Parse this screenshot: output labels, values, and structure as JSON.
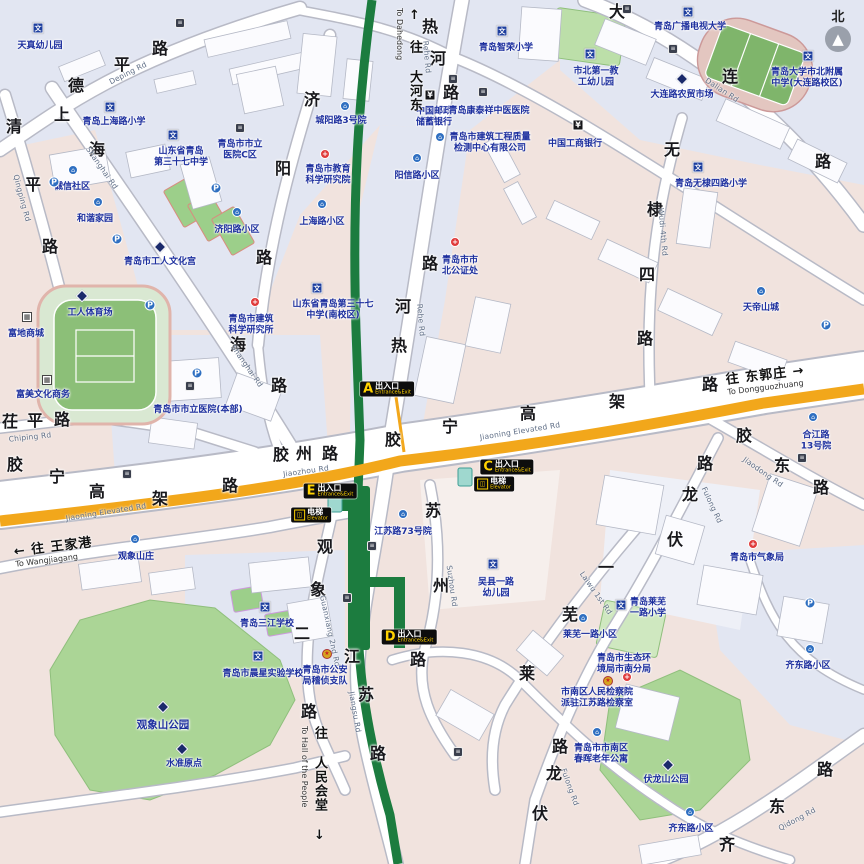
{
  "map": {
    "colors": {
      "metro_green": "#1c7c3f",
      "elevated_yellow": "#f2a71b",
      "park_green": "#abd596",
      "exit_badge_bg": "#0d0d0d",
      "exit_letter_yellow": "#ffd200",
      "label_blue": "#1d2f9e"
    },
    "compass": {
      "label": "北",
      "arrow": "▲"
    },
    "exits": [
      {
        "letter": "A",
        "cn": "出入口",
        "en": "Entrance&Exit",
        "x": 387,
        "y": 389
      },
      {
        "letter": "C",
        "cn": "出入口",
        "en": "Entrance&Exit",
        "x": 507,
        "y": 467
      },
      {
        "letter": "E",
        "cn": "出入口",
        "en": "Entrance&Exit",
        "x": 330,
        "y": 491
      },
      {
        "letter": "D",
        "cn": "出入口",
        "en": "Entrance&Exit",
        "x": 409,
        "y": 637
      }
    ],
    "elevators": [
      {
        "cn": "电梯",
        "en": "Elevator",
        "x": 311,
        "y": 515
      },
      {
        "cn": "电梯",
        "en": "Elevator",
        "x": 494,
        "y": 484
      }
    ],
    "direction_signs": [
      {
        "id": "to-dahedong",
        "arrow": "↑",
        "cn": "往 大河东",
        "en": "To Dahedong",
        "x": 395,
        "y": 8,
        "orient": "v"
      },
      {
        "id": "to-wangjiagang",
        "arrow": "←",
        "cn": "往 王家港",
        "en": "To Wangjiagang",
        "x": 14,
        "y": 536,
        "orient": "h"
      },
      {
        "id": "to-dongguozhuang",
        "arrow": "→",
        "cn": "往 东郭庄",
        "en": "To Dongguozhuang",
        "x": 726,
        "y": 364,
        "orient": "hr"
      },
      {
        "id": "to-hall-of-the-people",
        "arrow": "↓",
        "cn": "往 人民会堂",
        "en": "To Hall of the People",
        "x": 300,
        "y": 726,
        "orient": "vd"
      }
    ],
    "road_chars": [
      {
        "t": "德",
        "x": 76,
        "y": 84
      },
      {
        "t": "平",
        "x": 122,
        "y": 63
      },
      {
        "t": "路",
        "x": 160,
        "y": 47
      },
      {
        "t": "清",
        "x": 14,
        "y": 125
      },
      {
        "t": "平",
        "x": 33,
        "y": 183
      },
      {
        "t": "路",
        "x": 50,
        "y": 245
      },
      {
        "t": "上",
        "x": 62,
        "y": 113
      },
      {
        "t": "海",
        "x": 97,
        "y": 148
      },
      {
        "t": "海",
        "x": 238,
        "y": 343
      },
      {
        "t": "路",
        "x": 279,
        "y": 384
      },
      {
        "t": "济",
        "x": 312,
        "y": 98
      },
      {
        "t": "阳",
        "x": 283,
        "y": 167
      },
      {
        "t": "路",
        "x": 264,
        "y": 256
      },
      {
        "t": "热",
        "x": 430,
        "y": 25
      },
      {
        "t": "河",
        "x": 438,
        "y": 57
      },
      {
        "t": "路",
        "x": 451,
        "y": 91
      },
      {
        "t": "路",
        "x": 430,
        "y": 262
      },
      {
        "t": "河",
        "x": 403,
        "y": 305
      },
      {
        "t": "热",
        "x": 399,
        "y": 344
      },
      {
        "t": "大",
        "x": 617,
        "y": 10
      },
      {
        "t": "连",
        "x": 730,
        "y": 75
      },
      {
        "t": "路",
        "x": 823,
        "y": 160
      },
      {
        "t": "无",
        "x": 672,
        "y": 148
      },
      {
        "t": "棣",
        "x": 655,
        "y": 208
      },
      {
        "t": "四",
        "x": 647,
        "y": 273
      },
      {
        "t": "路",
        "x": 645,
        "y": 337
      },
      {
        "t": "胶",
        "x": 15,
        "y": 463
      },
      {
        "t": "宁",
        "x": 57,
        "y": 475
      },
      {
        "t": "高",
        "x": 97,
        "y": 490
      },
      {
        "t": "架",
        "x": 160,
        "y": 497
      },
      {
        "t": "路",
        "x": 230,
        "y": 484
      },
      {
        "t": "胶",
        "x": 393,
        "y": 438
      },
      {
        "t": "宁",
        "x": 450,
        "y": 425
      },
      {
        "t": "高",
        "x": 528,
        "y": 412
      },
      {
        "t": "架",
        "x": 617,
        "y": 400
      },
      {
        "t": "路",
        "x": 710,
        "y": 383
      },
      {
        "t": "胶",
        "x": 281,
        "y": 453
      },
      {
        "t": "州",
        "x": 304,
        "y": 452
      },
      {
        "t": "路",
        "x": 330,
        "y": 452
      },
      {
        "t": "茌",
        "x": 10,
        "y": 420
      },
      {
        "t": "平",
        "x": 35,
        "y": 419
      },
      {
        "t": "路",
        "x": 62,
        "y": 418
      },
      {
        "t": "苏",
        "x": 433,
        "y": 509
      },
      {
        "t": "州",
        "x": 441,
        "y": 584
      },
      {
        "t": "路",
        "x": 418,
        "y": 658
      },
      {
        "t": "江",
        "x": 352,
        "y": 655
      },
      {
        "t": "苏",
        "x": 366,
        "y": 693
      },
      {
        "t": "路",
        "x": 378,
        "y": 752
      },
      {
        "t": "观",
        "x": 325,
        "y": 545
      },
      {
        "t": "象",
        "x": 318,
        "y": 588
      },
      {
        "t": "二",
        "x": 302,
        "y": 632
      },
      {
        "t": "路",
        "x": 309,
        "y": 710
      },
      {
        "t": "一",
        "x": 606,
        "y": 566
      },
      {
        "t": "芜",
        "x": 570,
        "y": 613
      },
      {
        "t": "莱",
        "x": 527,
        "y": 672
      },
      {
        "t": "伏",
        "x": 675,
        "y": 538
      },
      {
        "t": "龙",
        "x": 690,
        "y": 493
      },
      {
        "t": "路",
        "x": 705,
        "y": 462
      },
      {
        "t": "伏",
        "x": 540,
        "y": 812
      },
      {
        "t": "龙",
        "x": 554,
        "y": 772
      },
      {
        "t": "路",
        "x": 560,
        "y": 745
      },
      {
        "t": "胶",
        "x": 744,
        "y": 434
      },
      {
        "t": "东",
        "x": 782,
        "y": 464
      },
      {
        "t": "路",
        "x": 821,
        "y": 486
      },
      {
        "t": "齐",
        "x": 727,
        "y": 843
      },
      {
        "t": "东",
        "x": 777,
        "y": 805
      },
      {
        "t": "路",
        "x": 825,
        "y": 768
      }
    ],
    "road_names_en": [
      {
        "t": "Deping Rd",
        "x": 128,
        "y": 73,
        "r": -27
      },
      {
        "t": "Qingping Rd",
        "x": 22,
        "y": 198,
        "r": 75
      },
      {
        "t": "Shanghai Rd",
        "x": 102,
        "y": 168,
        "r": 55
      },
      {
        "t": "Shanghai Rd",
        "x": 247,
        "y": 366,
        "r": 55
      },
      {
        "t": "Rehe Rd",
        "x": 427,
        "y": 57,
        "r": 85
      },
      {
        "t": "Rehe Rd",
        "x": 421,
        "y": 320,
        "r": 85
      },
      {
        "t": "Jiaozhou Rd",
        "x": 306,
        "y": 471,
        "r": -8
      },
      {
        "t": "Jiaoning Elevated Rd",
        "x": 106,
        "y": 512,
        "r": -9
      },
      {
        "t": "Jiaoning Elevated Rd",
        "x": 520,
        "y": 431,
        "r": -9
      },
      {
        "t": "Chiping Rd",
        "x": 30,
        "y": 437,
        "r": -6
      },
      {
        "t": "Dalian Rd",
        "x": 722,
        "y": 90,
        "r": 33
      },
      {
        "t": "Wudi 4th Rd",
        "x": 663,
        "y": 232,
        "r": 85
      },
      {
        "t": "Suzhou Rd",
        "x": 452,
        "y": 586,
        "r": 82
      },
      {
        "t": "Jiangsu Rd",
        "x": 355,
        "y": 712,
        "r": 80
      },
      {
        "t": "Guanxiang 2nd Rd",
        "x": 330,
        "y": 631,
        "r": 78
      },
      {
        "t": "Laiwu 1st Rd",
        "x": 596,
        "y": 593,
        "r": 55
      },
      {
        "t": "Fulong Rd",
        "x": 712,
        "y": 505,
        "r": 65
      },
      {
        "t": "Fulong Rd",
        "x": 570,
        "y": 787,
        "r": 70
      },
      {
        "t": "Jiaodong Rd",
        "x": 763,
        "y": 472,
        "r": 35
      },
      {
        "t": "Qidong Rd",
        "x": 797,
        "y": 819,
        "r": -28
      }
    ],
    "pois": [
      {
        "icon": "wen",
        "x": 38,
        "y": 28,
        "lines": [
          "天真幼儿园"
        ],
        "tx": 40,
        "ty": 46
      },
      {
        "icon": "wen",
        "x": 110,
        "y": 107,
        "lines": [
          "青岛上海路小学"
        ],
        "tx": 114,
        "ty": 122
      },
      {
        "icon": "wen",
        "x": 173,
        "y": 135,
        "lines": [
          "山东省青岛",
          "第三十七中学"
        ],
        "tx": 181,
        "ty": 152
      },
      {
        "icon": "circle",
        "x": 73,
        "y": 170,
        "lines": [
          "诚信社区"
        ],
        "tx": 72,
        "ty": 187
      },
      {
        "icon": "circle",
        "x": 98,
        "y": 202,
        "lines": [
          "和谐家园"
        ],
        "tx": 95,
        "ty": 219
      },
      {
        "icon": "p",
        "x": 54,
        "y": 182,
        "lines": []
      },
      {
        "icon": "p",
        "x": 117,
        "y": 239,
        "lines": []
      },
      {
        "icon": "p",
        "x": 216,
        "y": 188,
        "lines": []
      },
      {
        "icon": "diamond",
        "x": 160,
        "y": 247,
        "lines": [
          "青岛市工人文化宫"
        ],
        "tx": 160,
        "ty": 262
      },
      {
        "icon": "circle",
        "x": 237,
        "y": 212,
        "lines": [
          "济阳路小区"
        ],
        "tx": 237,
        "ty": 230
      },
      {
        "icon": "dark",
        "x": 240,
        "y": 128,
        "lines": [
          "青岛市市立",
          "医院C区"
        ],
        "tx": 240,
        "ty": 145
      },
      {
        "icon": "dark",
        "x": 180,
        "y": 23,
        "lines": []
      },
      {
        "icon": "wen",
        "x": 317,
        "y": 288,
        "lines": [
          "山东省青岛第三十七",
          "中学(南校区)"
        ],
        "tx": 333,
        "ty": 305
      },
      {
        "icon": "red",
        "x": 325,
        "y": 154,
        "lines": [
          "青岛市教育",
          "科学研究院"
        ],
        "tx": 328,
        "ty": 170
      },
      {
        "icon": "circle",
        "x": 322,
        "y": 204,
        "lines": [
          "上海路小区"
        ],
        "tx": 322,
        "ty": 222
      },
      {
        "icon": "circle",
        "x": 345,
        "y": 106,
        "lines": [
          "城阳路3号院"
        ],
        "tx": 341,
        "ty": 121
      },
      {
        "icon": "yen",
        "x": 430,
        "y": 95,
        "lines": [
          "中国邮政",
          "储蓄银行"
        ],
        "tx": 434,
        "ty": 112
      },
      {
        "icon": "dark",
        "x": 483,
        "y": 92,
        "lines": [
          "青岛康泰祥中医医院"
        ],
        "tx": 489,
        "ty": 111
      },
      {
        "icon": "circle",
        "x": 440,
        "y": 137,
        "lines": [
          "青岛市建筑工程质量",
          "检测中心有限公司"
        ],
        "tx": 490,
        "ty": 138
      },
      {
        "icon": "wen",
        "x": 502,
        "y": 31,
        "lines": [
          "青岛智荣小学"
        ],
        "tx": 506,
        "ty": 48
      },
      {
        "icon": "red",
        "x": 455,
        "y": 242,
        "lines": [
          "青岛市市",
          "北公证处"
        ],
        "tx": 460,
        "ty": 261
      },
      {
        "icon": "wen",
        "x": 590,
        "y": 54,
        "lines": [
          "市北第一教",
          "工幼儿园"
        ],
        "tx": 596,
        "ty": 72
      },
      {
        "icon": "yen",
        "x": 578,
        "y": 125,
        "lines": [
          "中国工商银行"
        ],
        "tx": 575,
        "ty": 144
      },
      {
        "icon": "wen",
        "x": 688,
        "y": 12,
        "lines": [
          "青岛广播电视大学"
        ],
        "tx": 690,
        "ty": 27
      },
      {
        "icon": "wen",
        "x": 808,
        "y": 56,
        "lines": [
          "青岛大学市北附属",
          "中学(大连路校区)"
        ],
        "tx": 807,
        "ty": 73
      },
      {
        "icon": "diamond",
        "x": 682,
        "y": 79,
        "lines": [
          "大连路农贸市场"
        ],
        "tx": 682,
        "ty": 95
      },
      {
        "icon": "dark",
        "x": 673,
        "y": 49,
        "lines": []
      },
      {
        "icon": "dark",
        "x": 627,
        "y": 9,
        "lines": []
      },
      {
        "icon": "wen",
        "x": 698,
        "y": 167,
        "lines": [
          "青岛无棣四路小学"
        ],
        "tx": 711,
        "ty": 184
      },
      {
        "icon": "dark",
        "x": 190,
        "y": 386,
        "lines": [
          "青岛市市立医院(本部)"
        ],
        "tx": 198,
        "ty": 410
      },
      {
        "icon": "red",
        "x": 255,
        "y": 302,
        "lines": [
          "青岛市建筑",
          "科学研究所"
        ],
        "tx": 251,
        "ty": 320
      },
      {
        "icon": "p",
        "x": 150,
        "y": 305,
        "lines": []
      },
      {
        "icon": "p",
        "x": 197,
        "y": 373,
        "lines": []
      },
      {
        "icon": "diamond",
        "x": 82,
        "y": 296,
        "lines": [
          "工人体育场"
        ],
        "tx": 90,
        "ty": 313
      },
      {
        "icon": "bld",
        "x": 27,
        "y": 317,
        "lines": [
          "富地商城"
        ],
        "tx": 26,
        "ty": 334
      },
      {
        "icon": "bld",
        "x": 47,
        "y": 380,
        "lines": [
          "富美文化商务"
        ],
        "tx": 43,
        "ty": 395
      },
      {
        "icon": "circle",
        "x": 135,
        "y": 539,
        "lines": [
          "观象山庄"
        ],
        "tx": 136,
        "ty": 557
      },
      {
        "icon": "circle",
        "x": 403,
        "y": 514,
        "lines": [
          "江苏路73号院"
        ],
        "tx": 403,
        "ty": 532
      },
      {
        "icon": "circle",
        "x": 761,
        "y": 291,
        "lines": [
          "天帝山城"
        ],
        "tx": 761,
        "ty": 308
      },
      {
        "icon": "p",
        "x": 826,
        "y": 325,
        "lines": []
      },
      {
        "icon": "circle",
        "x": 813,
        "y": 417,
        "lines": [
          "合江路",
          "13号院"
        ],
        "tx": 816,
        "ty": 436
      },
      {
        "icon": "dark",
        "x": 802,
        "y": 458,
        "lines": []
      },
      {
        "icon": "red",
        "x": 753,
        "y": 544,
        "lines": [
          "青岛市气象局"
        ],
        "tx": 757,
        "ty": 558
      },
      {
        "icon": "wen",
        "x": 493,
        "y": 564,
        "lines": [
          "吴县一路",
          "幼儿园"
        ],
        "tx": 496,
        "ty": 583
      },
      {
        "icon": "wen",
        "x": 621,
        "y": 605,
        "lines": [
          "青岛莱芜",
          "一路小学"
        ],
        "tx": 648,
        "ty": 603
      },
      {
        "icon": "circle",
        "x": 583,
        "y": 618,
        "lines": [
          "莱芜一路小区"
        ],
        "tx": 590,
        "ty": 635
      },
      {
        "icon": "wen",
        "x": 265,
        "y": 607,
        "lines": [
          "青岛三江学校"
        ],
        "tx": 267,
        "ty": 624
      },
      {
        "icon": "wen",
        "x": 258,
        "y": 656,
        "lines": [
          "青岛市晨星实验学校"
        ],
        "tx": 263,
        "ty": 674
      },
      {
        "icon": "police",
        "x": 327,
        "y": 654,
        "lines": [
          "青岛市公安",
          "局稽侦支队"
        ],
        "tx": 325,
        "ty": 671
      },
      {
        "icon": "red",
        "x": 627,
        "y": 677,
        "lines": [
          "青岛市生态环",
          "境局市南分局"
        ],
        "tx": 624,
        "ty": 659
      },
      {
        "icon": "police",
        "x": 608,
        "y": 681,
        "lines": [
          "市南区人民检察院",
          "派驻江苏路检察室"
        ],
        "tx": 597,
        "ty": 693
      },
      {
        "icon": "circle",
        "x": 597,
        "y": 732,
        "lines": [
          "青岛市市南区",
          "春晖老年公寓"
        ],
        "tx": 601,
        "ty": 749
      },
      {
        "icon": "diamond",
        "x": 163,
        "y": 707,
        "lines": [
          "观象山公园"
        ],
        "big": true,
        "tx": 163,
        "ty": 725
      },
      {
        "icon": "diamond",
        "x": 182,
        "y": 749,
        "lines": [
          "水准原点"
        ],
        "tx": 184,
        "ty": 764
      },
      {
        "icon": "diamond",
        "x": 668,
        "y": 765,
        "lines": [
          "伏龙山公园"
        ],
        "tx": 666,
        "ty": 780
      },
      {
        "icon": "circle",
        "x": 810,
        "y": 649,
        "lines": [
          "齐东路小区"
        ],
        "tx": 808,
        "ty": 666
      },
      {
        "icon": "circle",
        "x": 690,
        "y": 812,
        "lines": [
          "齐东路小区"
        ],
        "tx": 691,
        "ty": 829
      },
      {
        "icon": "p",
        "x": 810,
        "y": 603,
        "lines": []
      },
      {
        "icon": "circle",
        "x": 417,
        "y": 158,
        "lines": [
          "阳信路小区"
        ],
        "tx": 417,
        "ty": 176
      },
      {
        "icon": "dark",
        "x": 453,
        "y": 79,
        "lines": []
      },
      {
        "icon": "dark",
        "x": 372,
        "y": 546,
        "lines": []
      },
      {
        "icon": "dark",
        "x": 347,
        "y": 598,
        "lines": []
      },
      {
        "icon": "dark",
        "x": 458,
        "y": 752,
        "lines": []
      },
      {
        "icon": "dark",
        "x": 127,
        "y": 474,
        "lines": []
      }
    ]
  }
}
